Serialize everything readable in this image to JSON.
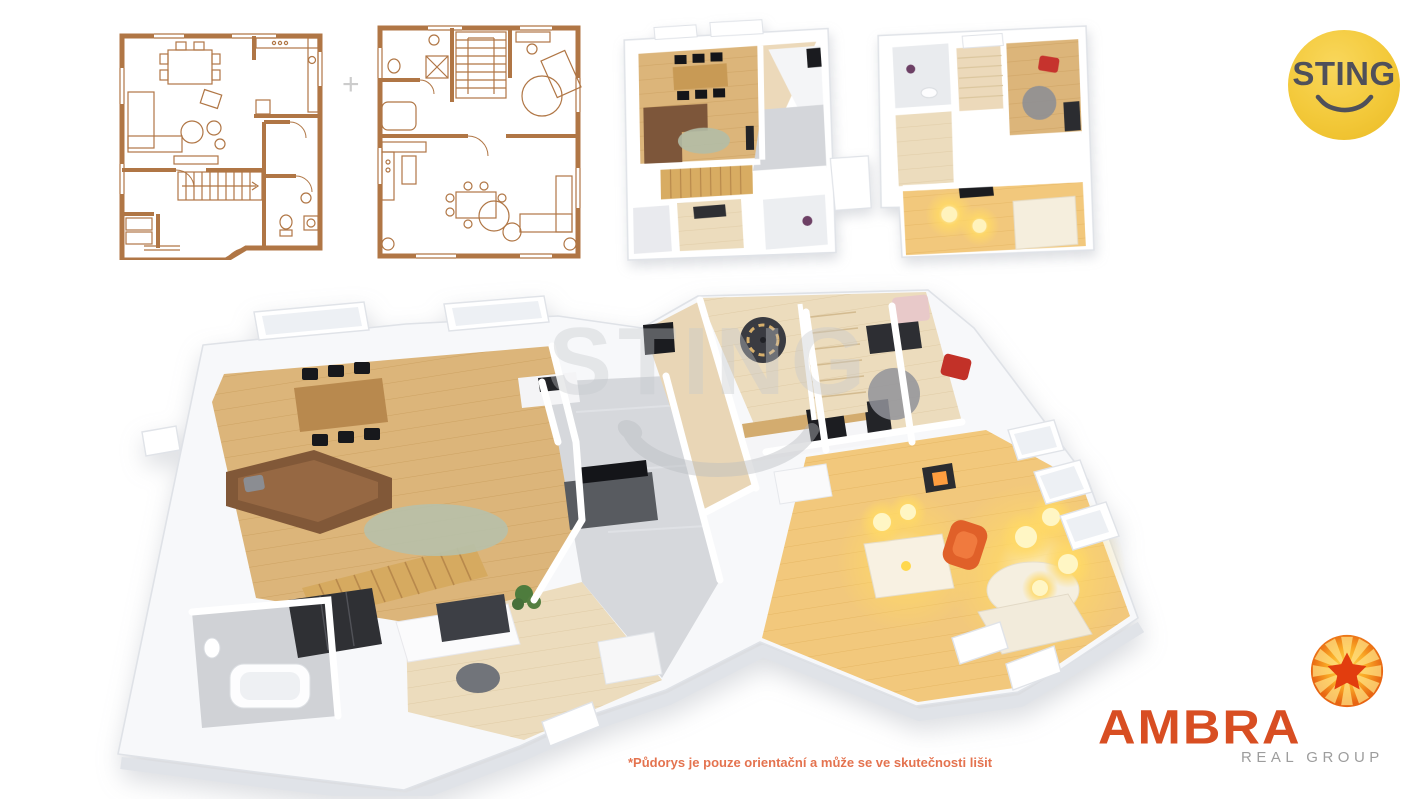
{
  "logos": {
    "sting": {
      "text": "STING",
      "circle_color": "#f3c93a",
      "text_color": "#4f505a",
      "icon": "smile-icon"
    },
    "ambra": {
      "name": "AMBRA",
      "subtitle": "REAL GROUP",
      "name_color": "#d84e22",
      "subtitle_color": "#9d9d9d",
      "icon": "sunburst-icon"
    }
  },
  "watermark": {
    "text": "STING",
    "icon": "smile-icon"
  },
  "plans": {
    "separator_plus": "+",
    "plan_2d_ground": "2d-floorplan-ground",
    "plan_2d_upper": "2d-floorplan-upper",
    "render_top": "3d-render-both-floors-top-view",
    "render_main": "3d-render-main-floor-isometric"
  },
  "footer": {
    "disclaimer": "*Půdorys je pouze orientační a může se ve skutečnosti lišit",
    "color": "#e4734f"
  },
  "palette": {
    "plan_ink": "#b07645",
    "wall_white": "#ffffff",
    "wood_floor": "#dcb57a",
    "pale_wood": "#ecdcbd",
    "warm_floor": "#f2c87c",
    "tile_gray": "#d5d7db",
    "sofa_brown": "#815838",
    "rug_green": "#b7c0a8",
    "stair_wood": "#d6aa60",
    "accent_red": "#c23128",
    "accent_orange": "#e06029",
    "lamp_glow": "#ffd966"
  }
}
